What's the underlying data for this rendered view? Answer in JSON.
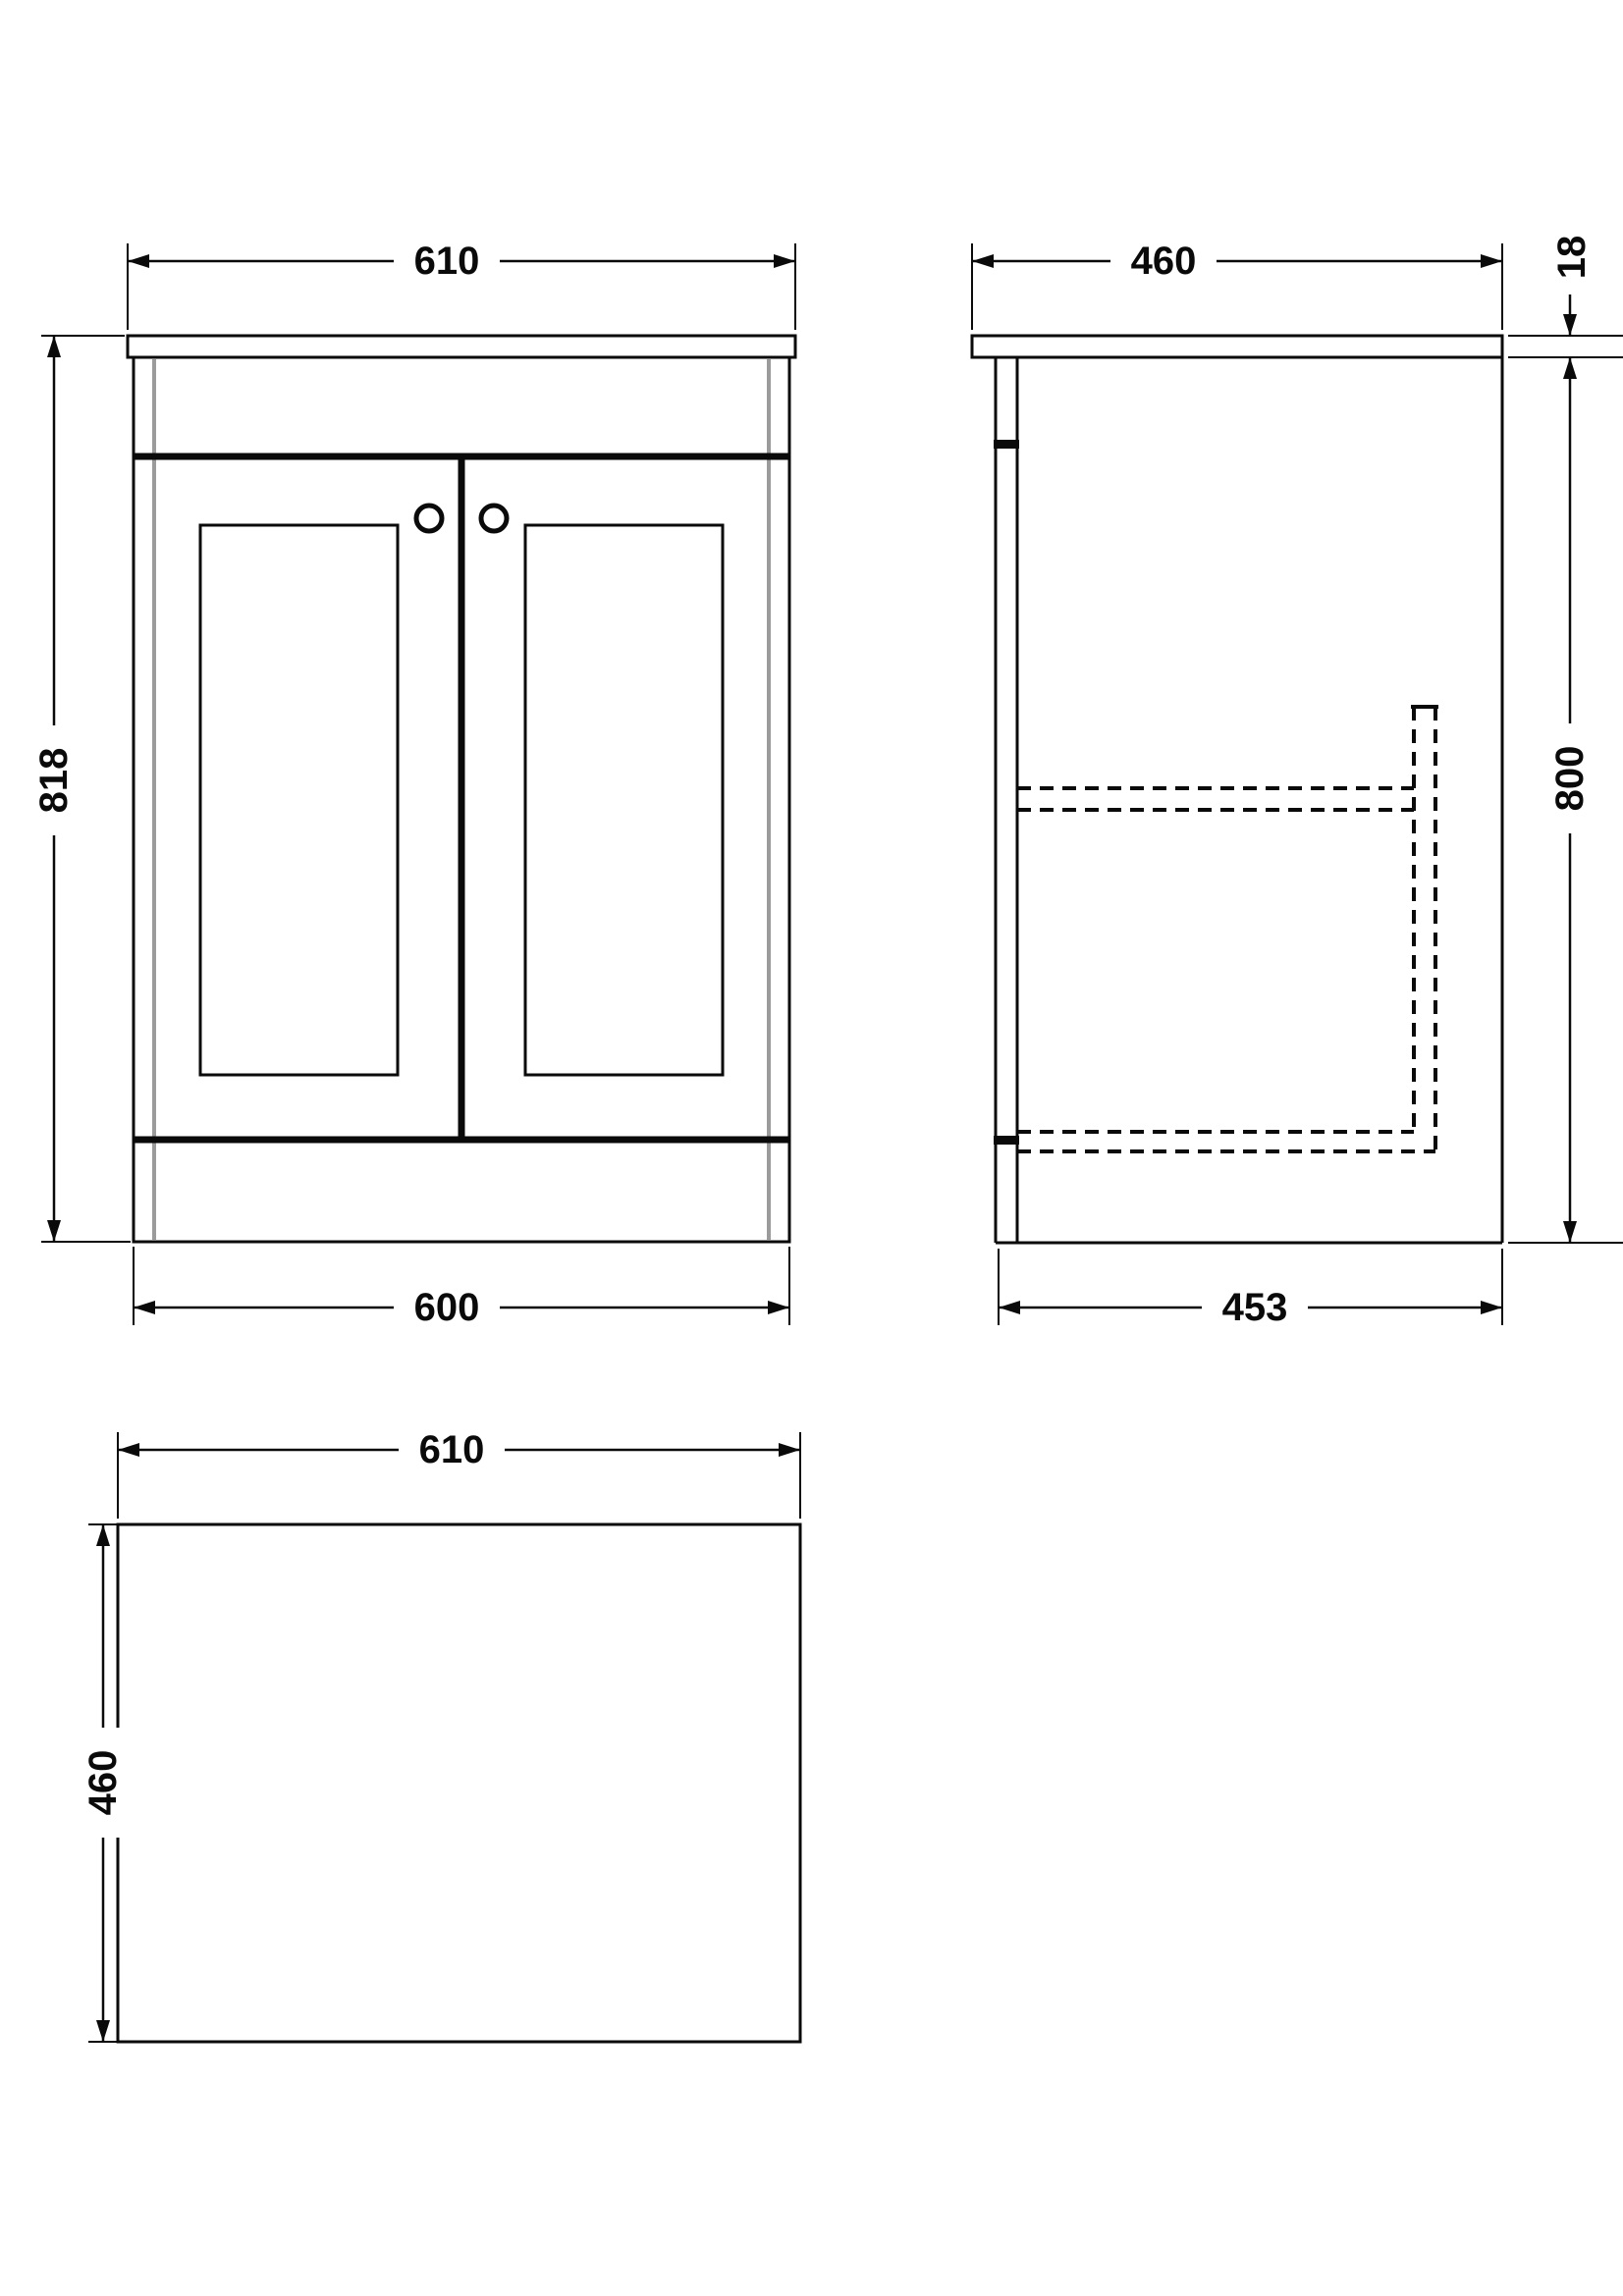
{
  "drawing": {
    "type": "furniture-dimension-diagram",
    "subject": "two-door floor-standing vanity unit, three orthographic views",
    "units": "mm"
  },
  "colors": {
    "line": "#0a0a0a",
    "accent": "#9b9b9b",
    "background": "#ffffff"
  },
  "dims": {
    "front_width_top": "610",
    "front_height": "818",
    "front_width_bottom": "600",
    "side_depth_top": "460",
    "side_counter_thickness": "18",
    "side_height": "800",
    "side_depth_bottom": "453",
    "plan_width": "610",
    "plan_depth": "460"
  }
}
